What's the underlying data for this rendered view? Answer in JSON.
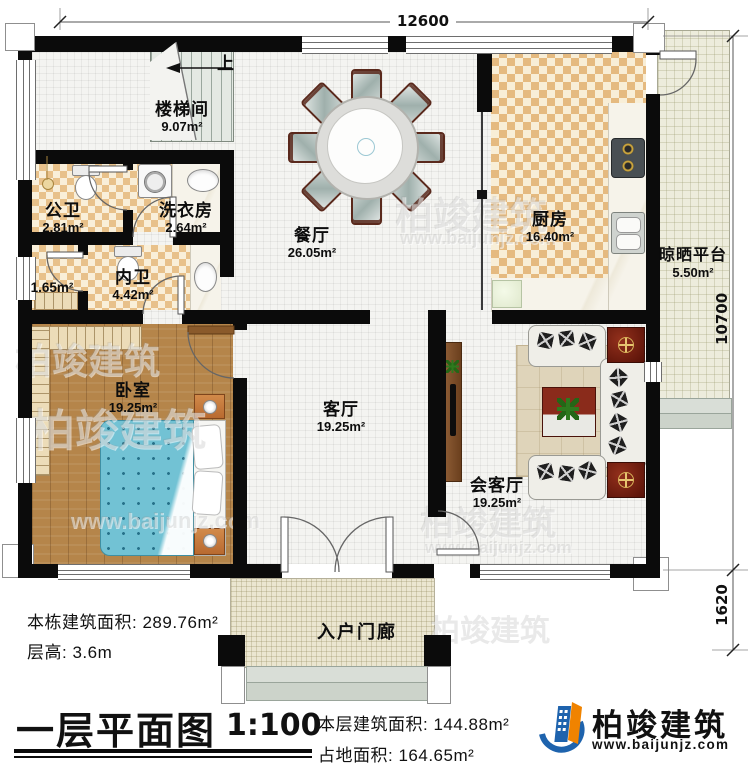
{
  "plan": {
    "dimensions": {
      "top": "12600",
      "right": "10700",
      "right_lower": "1620"
    },
    "stair_up": "上",
    "rooms": {
      "stairwell": {
        "name": "楼梯间",
        "area": "9.07m²"
      },
      "public_bath": {
        "name": "公卫",
        "area": "2.81m²"
      },
      "laundry": {
        "name": "洗衣房",
        "area": "2.64m²"
      },
      "closet": {
        "area": "1.65m²"
      },
      "inner_bath": {
        "name": "内卫",
        "area": "4.42m²"
      },
      "dining": {
        "name": "餐厅",
        "area": "26.05m²"
      },
      "kitchen": {
        "name": "厨房",
        "area": "16.40m²"
      },
      "platform": {
        "name": "晾晒平台",
        "area": "5.50m²"
      },
      "bedroom": {
        "name": "卧室",
        "area": "19.25m²"
      },
      "living": {
        "name": "客厅",
        "area": "19.25m²"
      },
      "reception": {
        "name": "会客厅",
        "area": "19.25m²"
      },
      "porch": {
        "name": "入户门廊"
      }
    },
    "titleblock": {
      "building_area_label": "本栋建筑面积:",
      "building_area": "289.76m²",
      "floor_height_label": "层高:",
      "floor_height": "3.6m",
      "title": "一层平面图",
      "scale": "1:100",
      "floor_area_label": "本层建筑面积:",
      "floor_area": "144.88m²",
      "footprint_label": "占地面积:",
      "footprint": "164.65m²"
    },
    "brand": {
      "name": "柏竣建筑",
      "url": "www.baijunjz.com"
    },
    "watermark": {
      "name": "柏竣建筑",
      "url": "www.baijunjz.com"
    }
  }
}
